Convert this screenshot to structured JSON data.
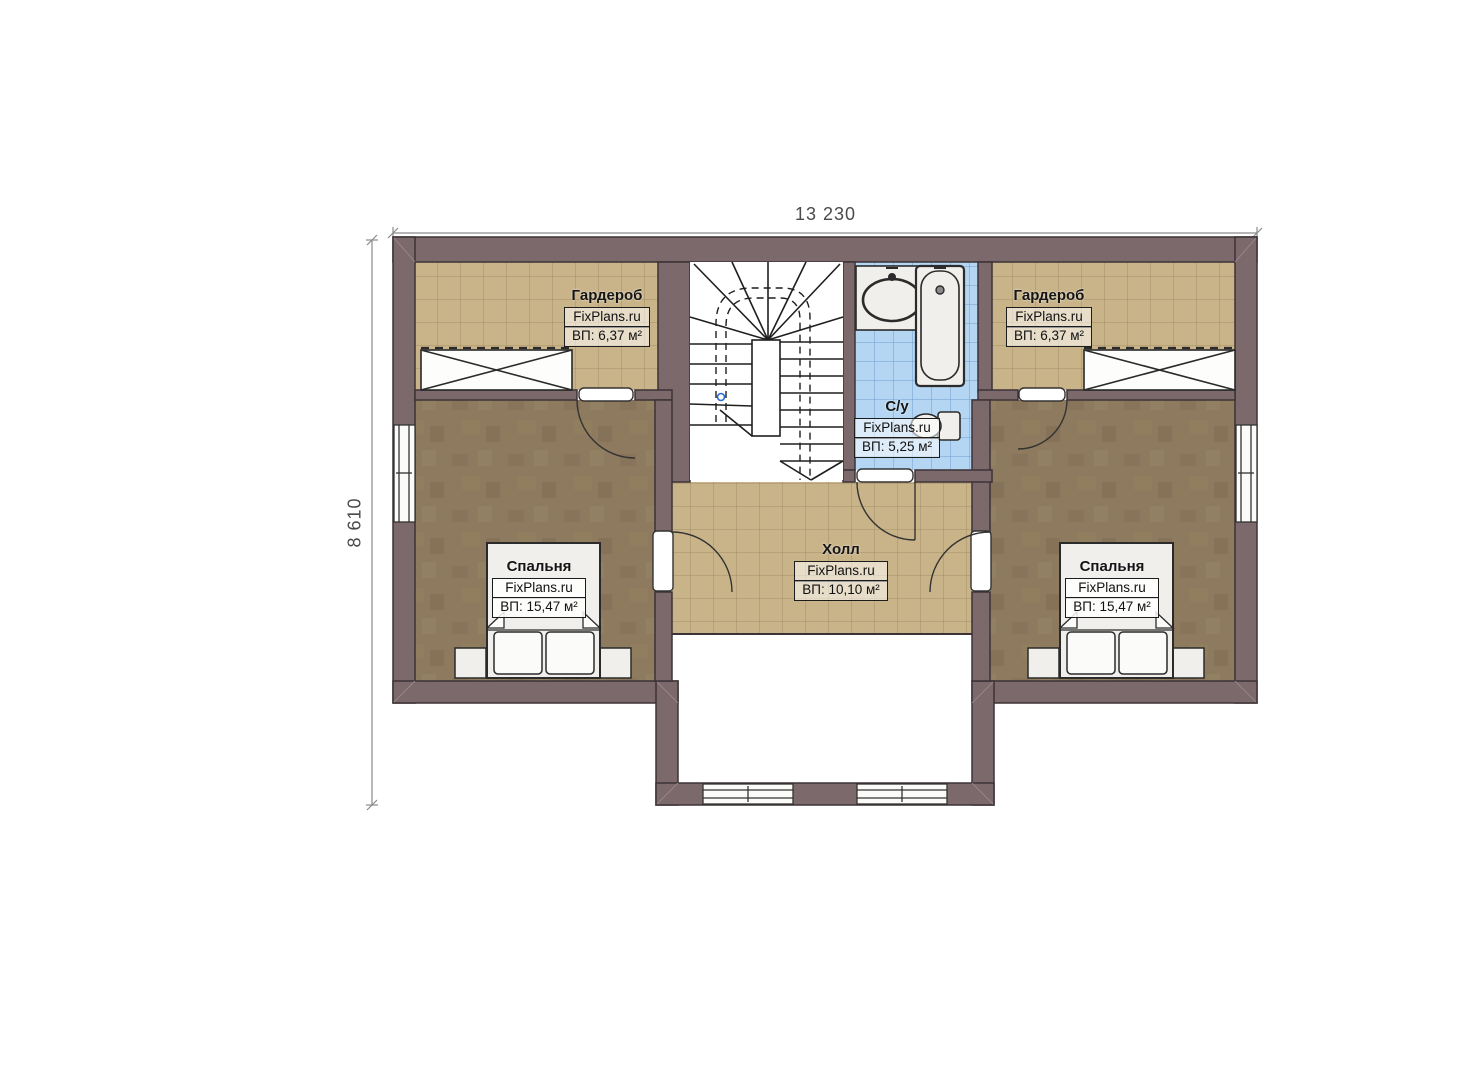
{
  "title": "Floor plan — second storey",
  "dimensions": {
    "width_label": "13 230",
    "height_label": "8 610"
  },
  "rooms": {
    "wardrobe_left": {
      "name": "Гардероб",
      "brand": "FixPlans.ru",
      "area": "ВП: 6,37 м²"
    },
    "wardrobe_right": {
      "name": "Гардероб",
      "brand": "FixPlans.ru",
      "area": "ВП: 6,37 м²"
    },
    "bathroom": {
      "name": "С/у",
      "brand": "FixPlans.ru",
      "area": "ВП: 5,25 м²"
    },
    "hall": {
      "name": "Холл",
      "brand": "FixPlans.ru",
      "area": "ВП: 10,10 м²"
    },
    "bedroom_left": {
      "name": "Спальня",
      "brand": "FixPlans.ru",
      "area": "ВП: 15,47 м²"
    },
    "bedroom_right": {
      "name": "Спальня",
      "brand": "FixPlans.ru",
      "area": "ВП: 15,47 м²"
    }
  },
  "colors": {
    "wall": "#7c696c",
    "wall_outline": "#3c3336",
    "tile_tan": "#c9b388",
    "tile_tan_grid": "#97835c",
    "tile_blue": "#b5d6f2",
    "tile_blue_grid": "#5f8ec4",
    "carpet": "#8d7a5f",
    "fixture_white": "#f0efec",
    "dimension_line": "#8a8a8a"
  }
}
